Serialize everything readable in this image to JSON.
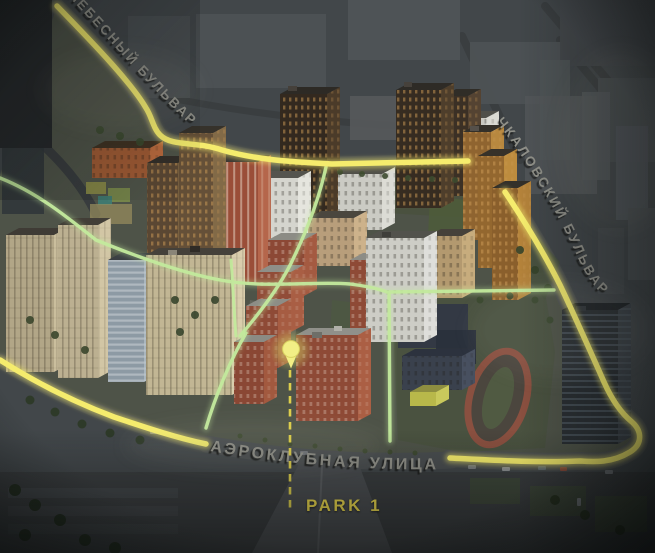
{
  "map": {
    "streets": [
      {
        "id": "nebesny-bulvar",
        "label": "НЕБЕСНЫЙ БУЛЬВАР"
      },
      {
        "id": "chkalovsky-bulvar",
        "label": "ЧКАЛОВСКИЙ БУЛЬВАР"
      },
      {
        "id": "aeroklubnaya-ulitsa",
        "label": "АЭРОКЛУБНАЯ УЛИЦА"
      }
    ],
    "poi": {
      "label": "PARK 1"
    },
    "colors": {
      "road_highlight": "#f5ec6d",
      "footpath": "#c3ea9d",
      "street_label": "#97978f",
      "poi_label": "#edda4e",
      "guide_dash": "#e5d54d",
      "marker": "#f2ef85",
      "marker_halo": "#b9b95c"
    }
  }
}
